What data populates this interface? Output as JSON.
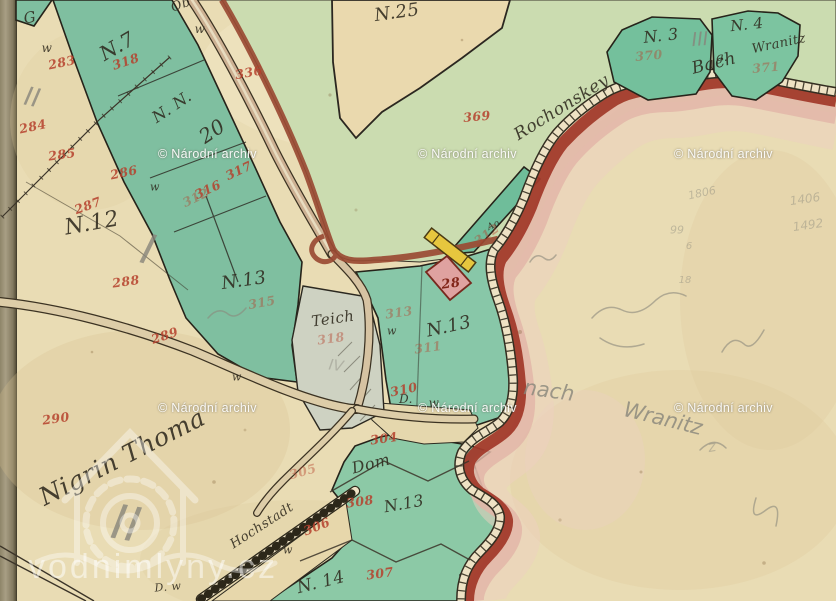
{
  "palette": {
    "paper": "#e9dcb4",
    "parcel_green": "#84c4a4",
    "pale_green": "#cbdcb0",
    "boundary_red": "#a23a2b",
    "boundary_pink": "#e2b6a8",
    "road_tan": "#cdb193",
    "pond_gray": "#ced2c2",
    "building_pink": "#dfa2a0",
    "building_yellow": "#e6c63e",
    "red_ink": "#b5402c",
    "black_ink": "#2f2a1e",
    "pencil_gray": "#87857b",
    "binding": "#9a9178"
  },
  "watermarks": {
    "archive": {
      "text": "© Národní archiv",
      "positions": [
        {
          "x": 158,
          "y": 147
        },
        {
          "x": 418,
          "y": 147
        },
        {
          "x": 674,
          "y": 147
        },
        {
          "x": 158,
          "y": 401
        },
        {
          "x": 418,
          "y": 401
        },
        {
          "x": 674,
          "y": 401
        }
      ]
    },
    "vodnimlyny": {
      "text": "vodnimlyny.cz"
    }
  },
  "map": {
    "ink_labels": [
      {
        "t": "G",
        "x": 30,
        "y": 18,
        "s": 15,
        "r": -10
      },
      {
        "t": "Ob",
        "x": 181,
        "y": 5,
        "s": 13,
        "r": -20
      },
      {
        "t": "w",
        "x": 200,
        "y": 29,
        "s": 12,
        "r": 0
      },
      {
        "t": "w",
        "x": 47,
        "y": 48,
        "s": 12,
        "r": 0
      },
      {
        "t": "N.7",
        "x": 117,
        "y": 46,
        "s": 20,
        "r": -30
      },
      {
        "t": "N. N.",
        "x": 172,
        "y": 107,
        "s": 16,
        "r": -34
      },
      {
        "t": "20",
        "x": 212,
        "y": 131,
        "s": 20,
        "r": -34
      },
      {
        "t": "N.25",
        "x": 397,
        "y": 13,
        "s": 18,
        "r": -8
      },
      {
        "t": "N. 3",
        "x": 661,
        "y": 36,
        "s": 16,
        "r": -6
      },
      {
        "t": "N. 4",
        "x": 747,
        "y": 25,
        "s": 15,
        "r": -6
      },
      {
        "t": "Wranitz",
        "x": 779,
        "y": 44,
        "s": 13,
        "r": -12
      },
      {
        "t": "g.",
        "x": 722,
        "y": 57,
        "s": 12,
        "r": 0
      },
      {
        "t": "N.12",
        "x": 92,
        "y": 224,
        "s": 22,
        "r": -10
      },
      {
        "t": "w",
        "x": 155,
        "y": 187,
        "s": 11,
        "r": 0
      },
      {
        "t": "N.13",
        "x": 244,
        "y": 281,
        "s": 18,
        "r": -8
      },
      {
        "t": "N.13",
        "x": 449,
        "y": 327,
        "s": 18,
        "r": -12
      },
      {
        "t": "Teich",
        "x": 333,
        "y": 319,
        "s": 15,
        "r": -8
      },
      {
        "t": "w",
        "x": 237,
        "y": 377,
        "s": 11,
        "r": 0
      },
      {
        "t": "w",
        "x": 392,
        "y": 331,
        "s": 11,
        "r": 0
      },
      {
        "t": "D.",
        "x": 406,
        "y": 399,
        "s": 12,
        "r": 0
      },
      {
        "t": "w",
        "x": 434,
        "y": 403,
        "s": 12,
        "r": 0
      },
      {
        "t": "Dom",
        "x": 371,
        "y": 464,
        "s": 16,
        "r": -14
      },
      {
        "t": "N.13",
        "x": 404,
        "y": 504,
        "s": 16,
        "r": -10
      },
      {
        "t": "N. 14",
        "x": 321,
        "y": 583,
        "s": 17,
        "r": -14
      },
      {
        "t": "Ao",
        "x": 494,
        "y": 226,
        "s": 9,
        "r": -25
      },
      {
        "t": "Rochonskey",
        "x": 562,
        "y": 108,
        "s": 17,
        "r": -32
      },
      {
        "t": "Bach",
        "x": 714,
        "y": 64,
        "s": 17,
        "r": -14
      },
      {
        "t": "Nigrin Thoma",
        "x": 122,
        "y": 457,
        "s": 25,
        "r": -27
      },
      {
        "t": "Hochstadt",
        "x": 262,
        "y": 526,
        "s": 13,
        "r": -33
      },
      {
        "t": "D. w",
        "x": 168,
        "y": 587,
        "s": 11,
        "r": -5
      },
      {
        "t": "w",
        "x": 288,
        "y": 550,
        "s": 11,
        "r": 0
      }
    ],
    "red_numbers": [
      {
        "t": "283",
        "x": 62,
        "y": 63,
        "r": -12
      },
      {
        "t": "284",
        "x": 33,
        "y": 127,
        "r": -12
      },
      {
        "t": "285",
        "x": 62,
        "y": 155,
        "r": -8
      },
      {
        "t": "286",
        "x": 124,
        "y": 173,
        "r": -12
      },
      {
        "t": "287",
        "x": 88,
        "y": 206,
        "r": -20
      },
      {
        "t": "288",
        "x": 126,
        "y": 282,
        "r": -8
      },
      {
        "t": "289",
        "x": 165,
        "y": 336,
        "r": -18
      },
      {
        "t": "290",
        "x": 56,
        "y": 419,
        "r": -8
      },
      {
        "t": "318",
        "x": 126,
        "y": 62,
        "r": -18
      },
      {
        "t": "336",
        "x": 249,
        "y": 73,
        "r": -10
      },
      {
        "t": "317",
        "x": 239,
        "y": 171,
        "r": -25
      },
      {
        "t": "316",
        "x": 208,
        "y": 190,
        "r": -25
      },
      {
        "t": "312",
        "x": 196,
        "y": 198,
        "r": -25,
        "faded": true
      },
      {
        "t": "369",
        "x": 477,
        "y": 117,
        "r": -5
      },
      {
        "t": "370",
        "x": 649,
        "y": 56,
        "r": -5,
        "faded": true
      },
      {
        "t": "371",
        "x": 766,
        "y": 68,
        "r": -5,
        "faded": true
      },
      {
        "t": "312",
        "x": 487,
        "y": 235,
        "r": -35,
        "faded": true
      },
      {
        "t": "315",
        "x": 262,
        "y": 303,
        "r": -10,
        "faded": true
      },
      {
        "t": "318",
        "x": 331,
        "y": 339,
        "r": -8,
        "faded": true
      },
      {
        "t": "313",
        "x": 399,
        "y": 313,
        "r": -8,
        "faded": true
      },
      {
        "t": "311",
        "x": 428,
        "y": 348,
        "r": -8,
        "faded": true
      },
      {
        "t": "310",
        "x": 404,
        "y": 390,
        "r": -12
      },
      {
        "t": "28",
        "x": 451,
        "y": 284,
        "r": -8,
        "s": 13,
        "dark": true
      },
      {
        "t": "304",
        "x": 384,
        "y": 439,
        "r": -8
      },
      {
        "t": "305",
        "x": 303,
        "y": 472,
        "r": -15,
        "faded": true
      },
      {
        "t": "308",
        "x": 360,
        "y": 502,
        "r": -8
      },
      {
        "t": "306",
        "x": 317,
        "y": 527,
        "r": -22
      },
      {
        "t": "307",
        "x": 380,
        "y": 574,
        "r": -8
      }
    ],
    "pencil_marks": [
      {
        "t": "II",
        "x": 32,
        "y": 98,
        "s": 26,
        "r": 12
      },
      {
        "t": "I",
        "x": 148,
        "y": 250,
        "s": 42,
        "r": 15
      },
      {
        "t": "II",
        "x": 126,
        "y": 524,
        "s": 48,
        "r": 10
      },
      {
        "t": "III",
        "x": 700,
        "y": 40,
        "s": 19,
        "r": -4
      },
      {
        "t": "IV",
        "x": 336,
        "y": 366,
        "s": 15,
        "r": 8,
        "faded": true
      },
      {
        "t": "1806",
        "x": 702,
        "y": 193,
        "s": 11,
        "r": -12,
        "faded": true
      },
      {
        "t": "99",
        "x": 677,
        "y": 230,
        "s": 11,
        "r": 0,
        "faded": true
      },
      {
        "t": "6",
        "x": 689,
        "y": 247,
        "s": 10,
        "r": 0,
        "faded": true
      },
      {
        "t": "18",
        "x": 685,
        "y": 281,
        "s": 10,
        "r": 0,
        "faded": true
      },
      {
        "t": "1406",
        "x": 805,
        "y": 199,
        "s": 12,
        "r": -8,
        "faded": true
      },
      {
        "t": "1492",
        "x": 808,
        "y": 225,
        "s": 12,
        "r": -8,
        "faded": true
      },
      {
        "t": "nach",
        "x": 549,
        "y": 391,
        "s": 21,
        "r": 8
      },
      {
        "t": "Wranitz",
        "x": 663,
        "y": 419,
        "s": 21,
        "r": 14
      },
      {
        "t": "z",
        "x": 712,
        "y": 447,
        "s": 15,
        "r": -10,
        "faded": true
      }
    ]
  }
}
